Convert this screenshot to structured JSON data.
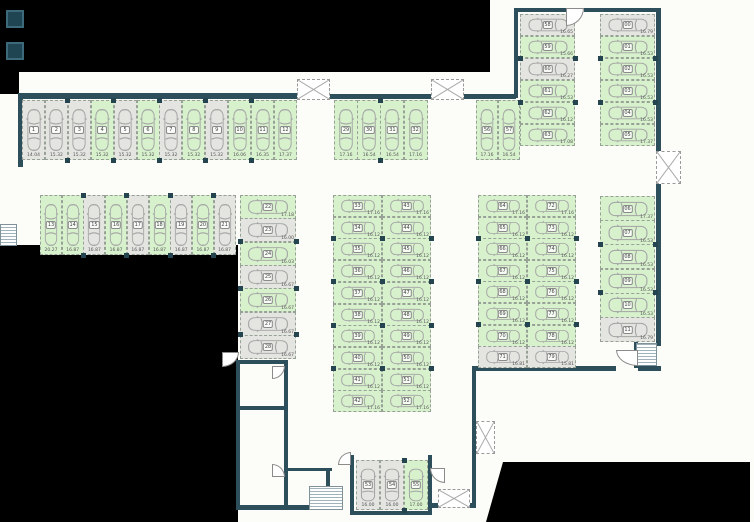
{
  "plan": {
    "title": "parking-level-floor-plan",
    "colors": {
      "free_stall": "#d7f1cd",
      "occupied_stall": "#e4e4e1",
      "wall": "#2d4f5c",
      "stall_border": "#98a196",
      "car_outline": "#a3a3a3",
      "dimension_text": "#555555",
      "outside_mask": "#000000"
    },
    "icons": [
      "car-icon",
      "stairs-icon",
      "ventilation-shaft-icon",
      "door-swing-icon"
    ],
    "groups": [
      {
        "name": "row-top-left",
        "orient": "v",
        "x": 22,
        "y": 100,
        "pitch": 22.9,
        "depth": 60,
        "stalls": [
          {
            "n": "1",
            "dim": "14.04",
            "free": false
          },
          {
            "n": "2",
            "dim": "15.32",
            "free": false
          },
          {
            "n": "3",
            "dim": "15.32",
            "free": false
          },
          {
            "n": "4",
            "dim": "15.32",
            "free": true
          },
          {
            "n": "5",
            "dim": "15.32",
            "free": false
          },
          {
            "n": "6",
            "dim": "15.32",
            "free": true
          },
          {
            "n": "7",
            "dim": "15.32",
            "free": false
          },
          {
            "n": "8",
            "dim": "15.32",
            "free": true
          },
          {
            "n": "9",
            "dim": "15.32",
            "free": false
          },
          {
            "n": "10",
            "dim": "16.06",
            "free": true
          },
          {
            "n": "11",
            "dim": "16.35",
            "free": true
          },
          {
            "n": "12",
            "dim": "17.37",
            "free": true
          }
        ]
      },
      {
        "name": "row-second-left",
        "orient": "v",
        "x": 40,
        "y": 195,
        "pitch": 21.7,
        "depth": 60,
        "stalls": [
          {
            "n": "13",
            "dim": "20.27",
            "free": true
          },
          {
            "n": "14",
            "dim": "16.87",
            "free": true
          },
          {
            "n": "15",
            "dim": "16.87",
            "free": false
          },
          {
            "n": "16",
            "dim": "16.87",
            "free": true
          },
          {
            "n": "17",
            "dim": "16.87",
            "free": false
          },
          {
            "n": "18",
            "dim": "16.87",
            "free": true
          },
          {
            "n": "19",
            "dim": "16.87",
            "free": false
          },
          {
            "n": "20",
            "dim": "16.87",
            "free": true
          },
          {
            "n": "21",
            "dim": "16.87",
            "free": false
          }
        ]
      },
      {
        "name": "column-left-side",
        "orient": "h",
        "x": 240,
        "y": 195,
        "pitch": 23.3,
        "depth": 56,
        "stalls": [
          {
            "n": "22",
            "dim": "17.18",
            "free": true
          },
          {
            "n": "23",
            "dim": "16.00",
            "free": false
          },
          {
            "n": "24",
            "dim": "16.03",
            "free": true
          },
          {
            "n": "25",
            "dim": "16.67",
            "free": false
          },
          {
            "n": "26",
            "dim": "16.67",
            "free": true
          },
          {
            "n": "27",
            "dim": "16.67",
            "free": false
          },
          {
            "n": "28",
            "dim": "16.67",
            "free": false
          }
        ]
      },
      {
        "name": "row-top-middle",
        "orient": "v",
        "x": 334,
        "y": 100,
        "pitch": 23.2,
        "depth": 60,
        "stalls": [
          {
            "n": "29",
            "dim": "17.16",
            "free": true
          },
          {
            "n": "30",
            "dim": "16.54",
            "free": true
          },
          {
            "n": "31",
            "dim": "16.54",
            "free": true
          },
          {
            "n": "32",
            "dim": "17.16",
            "free": true
          }
        ]
      },
      {
        "name": "row-top-right-pair",
        "orient": "v",
        "x": 476,
        "y": 100,
        "pitch": 22,
        "depth": 60,
        "stalls": [
          {
            "n": "56",
            "dim": "17.16",
            "free": true
          },
          {
            "n": "57",
            "dim": "16.54",
            "free": true
          }
        ]
      },
      {
        "name": "column-upper-left",
        "orient": "h",
        "x": 520,
        "y": 14,
        "pitch": 22,
        "depth": 55,
        "stalls": [
          {
            "n": "58",
            "dim": "16.65",
            "free": false
          },
          {
            "n": "59",
            "dim": "15.66",
            "free": true
          },
          {
            "n": "60",
            "dim": "16.27",
            "free": false
          },
          {
            "n": "61",
            "dim": "16.53",
            "free": true
          },
          {
            "n": "62",
            "dim": "16.12",
            "free": true
          },
          {
            "n": "63",
            "dim": "17.08",
            "free": true
          }
        ]
      },
      {
        "name": "column-upper-right",
        "orient": "h",
        "x": 600,
        "y": 14,
        "pitch": 22,
        "depth": 55,
        "stalls": [
          {
            "n": "00",
            "dim": "16.79",
            "free": false
          },
          {
            "n": "01",
            "dim": "16.53",
            "free": true
          },
          {
            "n": "02",
            "dim": "16.53",
            "free": true
          },
          {
            "n": "03",
            "dim": "16.53",
            "free": true
          },
          {
            "n": "04",
            "dim": "16.53",
            "free": true
          },
          {
            "n": "05",
            "dim": "17.37",
            "free": true
          }
        ]
      },
      {
        "name": "column-right-lower",
        "orient": "h",
        "x": 600,
        "y": 196,
        "pitch": 24.2,
        "depth": 55,
        "stalls": [
          {
            "n": "06",
            "dim": "17.37",
            "free": true
          },
          {
            "n": "07",
            "dim": "16.53",
            "free": true
          },
          {
            "n": "08",
            "dim": "16.53",
            "free": true
          },
          {
            "n": "09",
            "dim": "16.53",
            "free": true
          },
          {
            "n": "10",
            "dim": "16.53",
            "free": true
          },
          {
            "n": "11",
            "dim": "16.79",
            "free": false
          }
        ]
      },
      {
        "name": "island-middle-left",
        "orient": "h",
        "x": 333,
        "y": 195,
        "pitch": 21.7,
        "depth": 49,
        "stalls": [
          {
            "n": "33",
            "dim": "17.16",
            "free": true
          },
          {
            "n": "34",
            "dim": "16.12",
            "free": true
          },
          {
            "n": "35",
            "dim": "16.12",
            "free": true
          },
          {
            "n": "36",
            "dim": "16.12",
            "free": true
          },
          {
            "n": "37",
            "dim": "16.12",
            "free": true
          },
          {
            "n": "38",
            "dim": "16.12",
            "free": true
          },
          {
            "n": "39",
            "dim": "16.12",
            "free": true
          },
          {
            "n": "40",
            "dim": "16.12",
            "free": true
          },
          {
            "n": "41",
            "dim": "16.12",
            "free": true
          },
          {
            "n": "42",
            "dim": "17.16",
            "free": true
          }
        ]
      },
      {
        "name": "island-middle-right",
        "orient": "h",
        "x": 382,
        "y": 195,
        "pitch": 21.7,
        "depth": 49,
        "stalls": [
          {
            "n": "43",
            "dim": "17.16",
            "free": true
          },
          {
            "n": "44",
            "dim": "16.12",
            "free": true
          },
          {
            "n": "45",
            "dim": "16.12",
            "free": true
          },
          {
            "n": "46",
            "dim": "16.12",
            "free": true
          },
          {
            "n": "47",
            "dim": "16.12",
            "free": true
          },
          {
            "n": "48",
            "dim": "16.12",
            "free": true
          },
          {
            "n": "49",
            "dim": "16.12",
            "free": true
          },
          {
            "n": "50",
            "dim": "16.12",
            "free": true
          },
          {
            "n": "51",
            "dim": "16.12",
            "free": true
          },
          {
            "n": "52",
            "dim": "17.16",
            "free": true
          }
        ]
      },
      {
        "name": "island-right-left",
        "orient": "h",
        "x": 478,
        "y": 195,
        "pitch": 21.6,
        "depth": 49,
        "stalls": [
          {
            "n": "64",
            "dim": "17.16",
            "free": true
          },
          {
            "n": "65",
            "dim": "16.12",
            "free": true
          },
          {
            "n": "66",
            "dim": "16.12",
            "free": true
          },
          {
            "n": "67",
            "dim": "16.12",
            "free": true
          },
          {
            "n": "68",
            "dim": "16.12",
            "free": true
          },
          {
            "n": "69",
            "dim": "16.12",
            "free": true
          },
          {
            "n": "70",
            "dim": "16.12",
            "free": true
          },
          {
            "n": "71",
            "dim": "16.81",
            "free": false
          }
        ]
      },
      {
        "name": "island-right-right",
        "orient": "h",
        "x": 527,
        "y": 195,
        "pitch": 21.6,
        "depth": 49,
        "stalls": [
          {
            "n": "72",
            "dim": "17.16",
            "free": true
          },
          {
            "n": "73",
            "dim": "16.12",
            "free": true
          },
          {
            "n": "74",
            "dim": "16.12",
            "free": true
          },
          {
            "n": "75",
            "dim": "16.12",
            "free": true
          },
          {
            "n": "76",
            "dim": "16.12",
            "free": true
          },
          {
            "n": "77",
            "dim": "16.12",
            "free": true
          },
          {
            "n": "78",
            "dim": "16.12",
            "free": true
          },
          {
            "n": "79",
            "dim": "15.81",
            "free": false
          }
        ]
      },
      {
        "name": "row-bottom-middle",
        "orient": "v",
        "x": 356,
        "y": 460,
        "pitch": 24,
        "depth": 50,
        "stalls": [
          {
            "n": "53",
            "dim": "16.00",
            "free": false
          },
          {
            "n": "54",
            "dim": "16.00",
            "free": false
          },
          {
            "n": "55",
            "dim": "17.00",
            "free": true
          }
        ]
      }
    ]
  }
}
